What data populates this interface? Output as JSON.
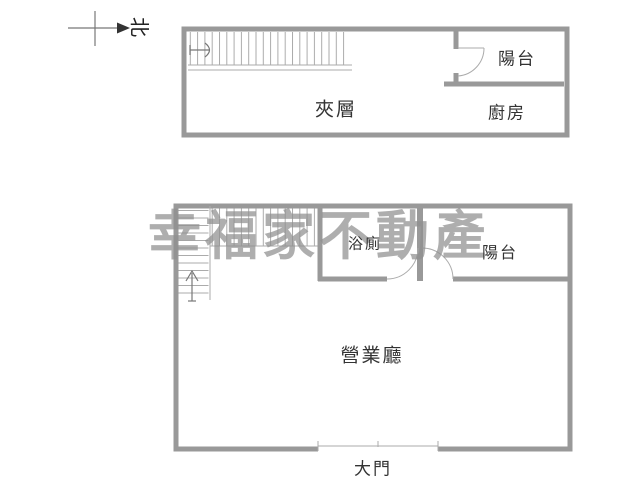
{
  "north": {
    "label": "北"
  },
  "watermark": {
    "text": "幸福家不動產"
  },
  "upper_floor": {
    "mezzanine": "夾層",
    "balcony": "陽台",
    "kitchen": "廚房"
  },
  "lower_floor": {
    "bathroom": "浴廁",
    "balcony": "陽台",
    "hall": "營業廳",
    "main_door": "大門"
  },
  "colors": {
    "wall": "#999999",
    "thin_line": "#ababab",
    "text": "#333333",
    "watermark": "#909090"
  }
}
